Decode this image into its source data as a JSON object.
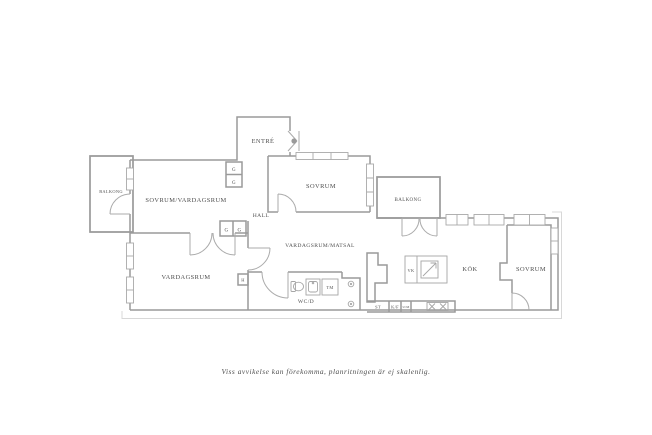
{
  "caption": "Viss avvikelse kan förekomma, planritningen är ej skalenlig.",
  "plan": {
    "rooms": {
      "balkong_left": "BALKONG",
      "sovrum_vardagsrum": "SOVRUM/VARDAGSRUM",
      "entre": "ENTRÉ",
      "hall": "HALL",
      "sovrum_mid": "SOVRUM",
      "balkong_right": "BALKONG",
      "vardagsrum_matsal": "VARDAGSRUM/MATSAL",
      "vardagsrum": "VARDAGSRUM",
      "wc_d": "WC/D",
      "kok": "KÖK",
      "sovrum_right": "SOVRUM"
    },
    "fixtures": {
      "g": "G",
      "h": "H",
      "tm": "TM",
      "st": "ST",
      "kf": "K/F",
      "um": "U/M",
      "vk": "VK"
    },
    "colors": {
      "wall": "#9a9a9a",
      "text": "#4f4f4f",
      "facade": "#d8d8d8",
      "fixture": "#a6a6a6"
    }
  }
}
